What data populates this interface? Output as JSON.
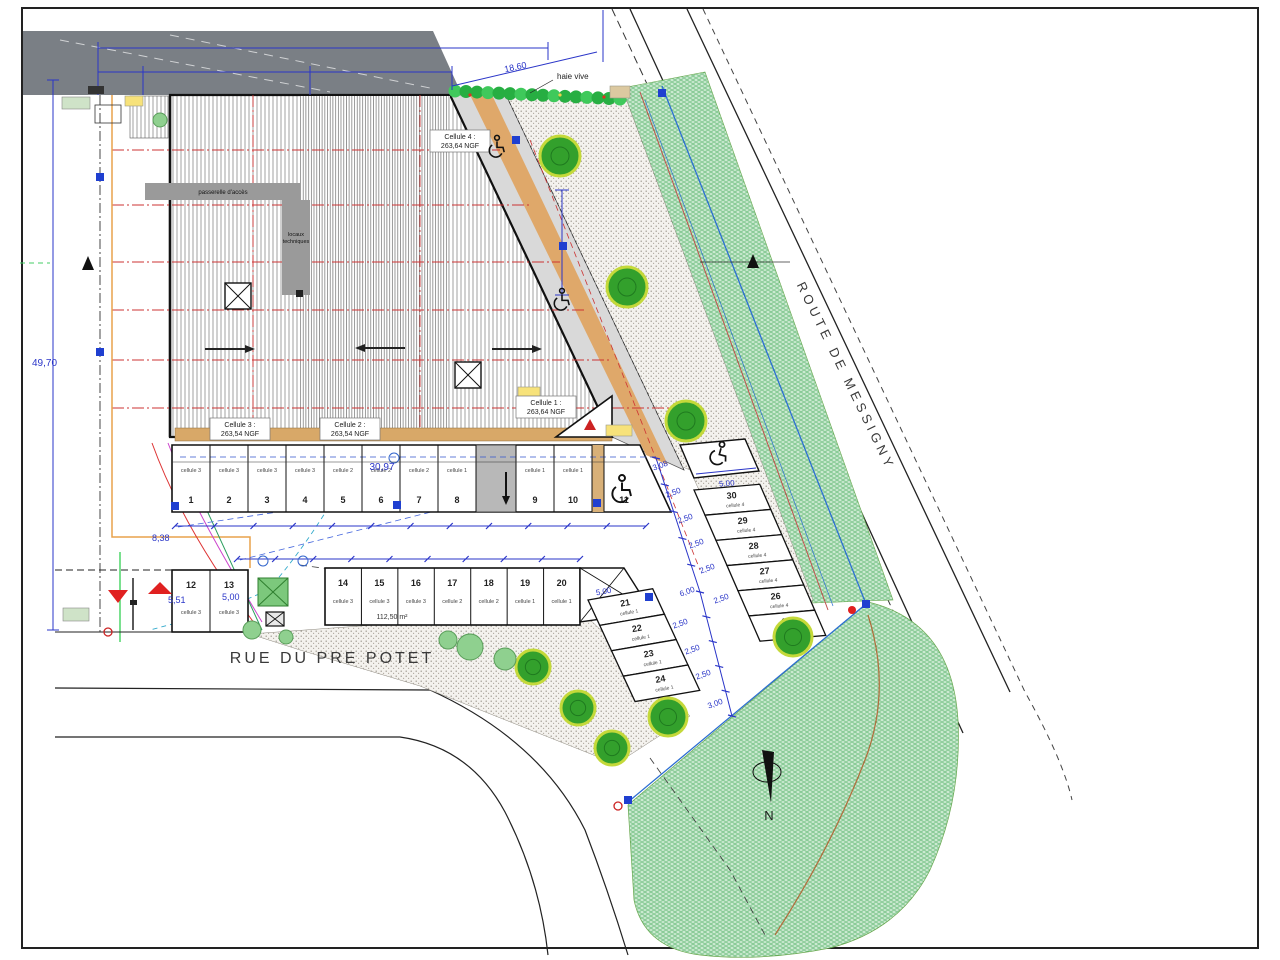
{
  "streets": {
    "bottom": "RUE DU PRE POTET",
    "right": "ROUTE DE MESSIGNY"
  },
  "north_label": "N",
  "hedge_label": "haie vive",
  "building": {
    "cells": [
      {
        "name": "Cellule 4 :",
        "level": "263,64 NGF"
      },
      {
        "name": "Cellule 3 :",
        "level": "263,54 NGF"
      },
      {
        "name": "Cellule 2 :",
        "level": "263,54 NGF"
      },
      {
        "name": "Cellule 1 :",
        "level": "263,64 NGF"
      }
    ],
    "corridor_label": "passerelle d'accès",
    "tech_label_1": "locaux",
    "tech_label_2": "techniques"
  },
  "parking": {
    "row_top": [
      {
        "n": "1",
        "c": "cellule 3"
      },
      {
        "n": "2",
        "c": "cellule 3"
      },
      {
        "n": "3",
        "c": "cellule 3"
      },
      {
        "n": "4",
        "c": "cellule 3"
      },
      {
        "n": "5",
        "c": "cellule 2"
      },
      {
        "n": "6",
        "c": "cellule 2"
      },
      {
        "n": "7",
        "c": "cellule 2"
      },
      {
        "n": "8",
        "c": "cellule 1"
      },
      {
        "n": "9",
        "c": "cellule 1"
      },
      {
        "n": "10",
        "c": "cellule 1"
      },
      {
        "n": "11",
        "c": ""
      }
    ],
    "row_left": [
      {
        "n": "12",
        "c": "cellule 3"
      },
      {
        "n": "13",
        "c": "cellule 3"
      }
    ],
    "row_mid": [
      {
        "n": "14",
        "c": "cellule 3"
      },
      {
        "n": "15",
        "c": "cellule 3"
      },
      {
        "n": "16",
        "c": "cellule 3"
      },
      {
        "n": "17",
        "c": "cellule 2"
      },
      {
        "n": "18",
        "c": "cellule 2"
      },
      {
        "n": "19",
        "c": "cellule 1"
      },
      {
        "n": "20",
        "c": "cellule 1"
      }
    ],
    "group_south": [
      {
        "n": "21",
        "c": "cellule 1"
      },
      {
        "n": "22",
        "c": "cellule 1"
      },
      {
        "n": "23",
        "c": "cellule 1"
      },
      {
        "n": "24",
        "c": "cellule 1"
      }
    ],
    "group_east": [
      {
        "n": "30",
        "c": "cellule 4"
      },
      {
        "n": "29",
        "c": "cellule 4"
      },
      {
        "n": "28",
        "c": "cellule 4"
      },
      {
        "n": "27",
        "c": "cellule 4"
      },
      {
        "n": "26",
        "c": "cellule 4"
      },
      {
        "n": "25",
        "c": "cellule 1"
      }
    ],
    "area_label": "112,50 m²"
  },
  "dimensions": {
    "left_height": "49,70",
    "top_right": "18,60",
    "stalls_width": "30,97",
    "offset": "8,38",
    "depth_a": "5,51",
    "depth_b": "5,00",
    "stall_width": "5,00",
    "chain": [
      "3,08",
      "2,50",
      "2,50",
      "2,50",
      "2,50",
      "6,00",
      "2,50",
      "2,50",
      "2,50",
      "2,50",
      "3,00"
    ]
  },
  "colors": {
    "dimension_blue": "#2a35c8",
    "grid_red": "#cc3333",
    "utility_blue": "#2d6fd2",
    "tree_green": "#33a02c",
    "lawn_green": "#cdebd2",
    "hedge_green": "#27ae42",
    "walkway_grey": "#d9d9d9",
    "dock_tan": "#d8a868",
    "neighbor_grey": "#7a7f85"
  }
}
